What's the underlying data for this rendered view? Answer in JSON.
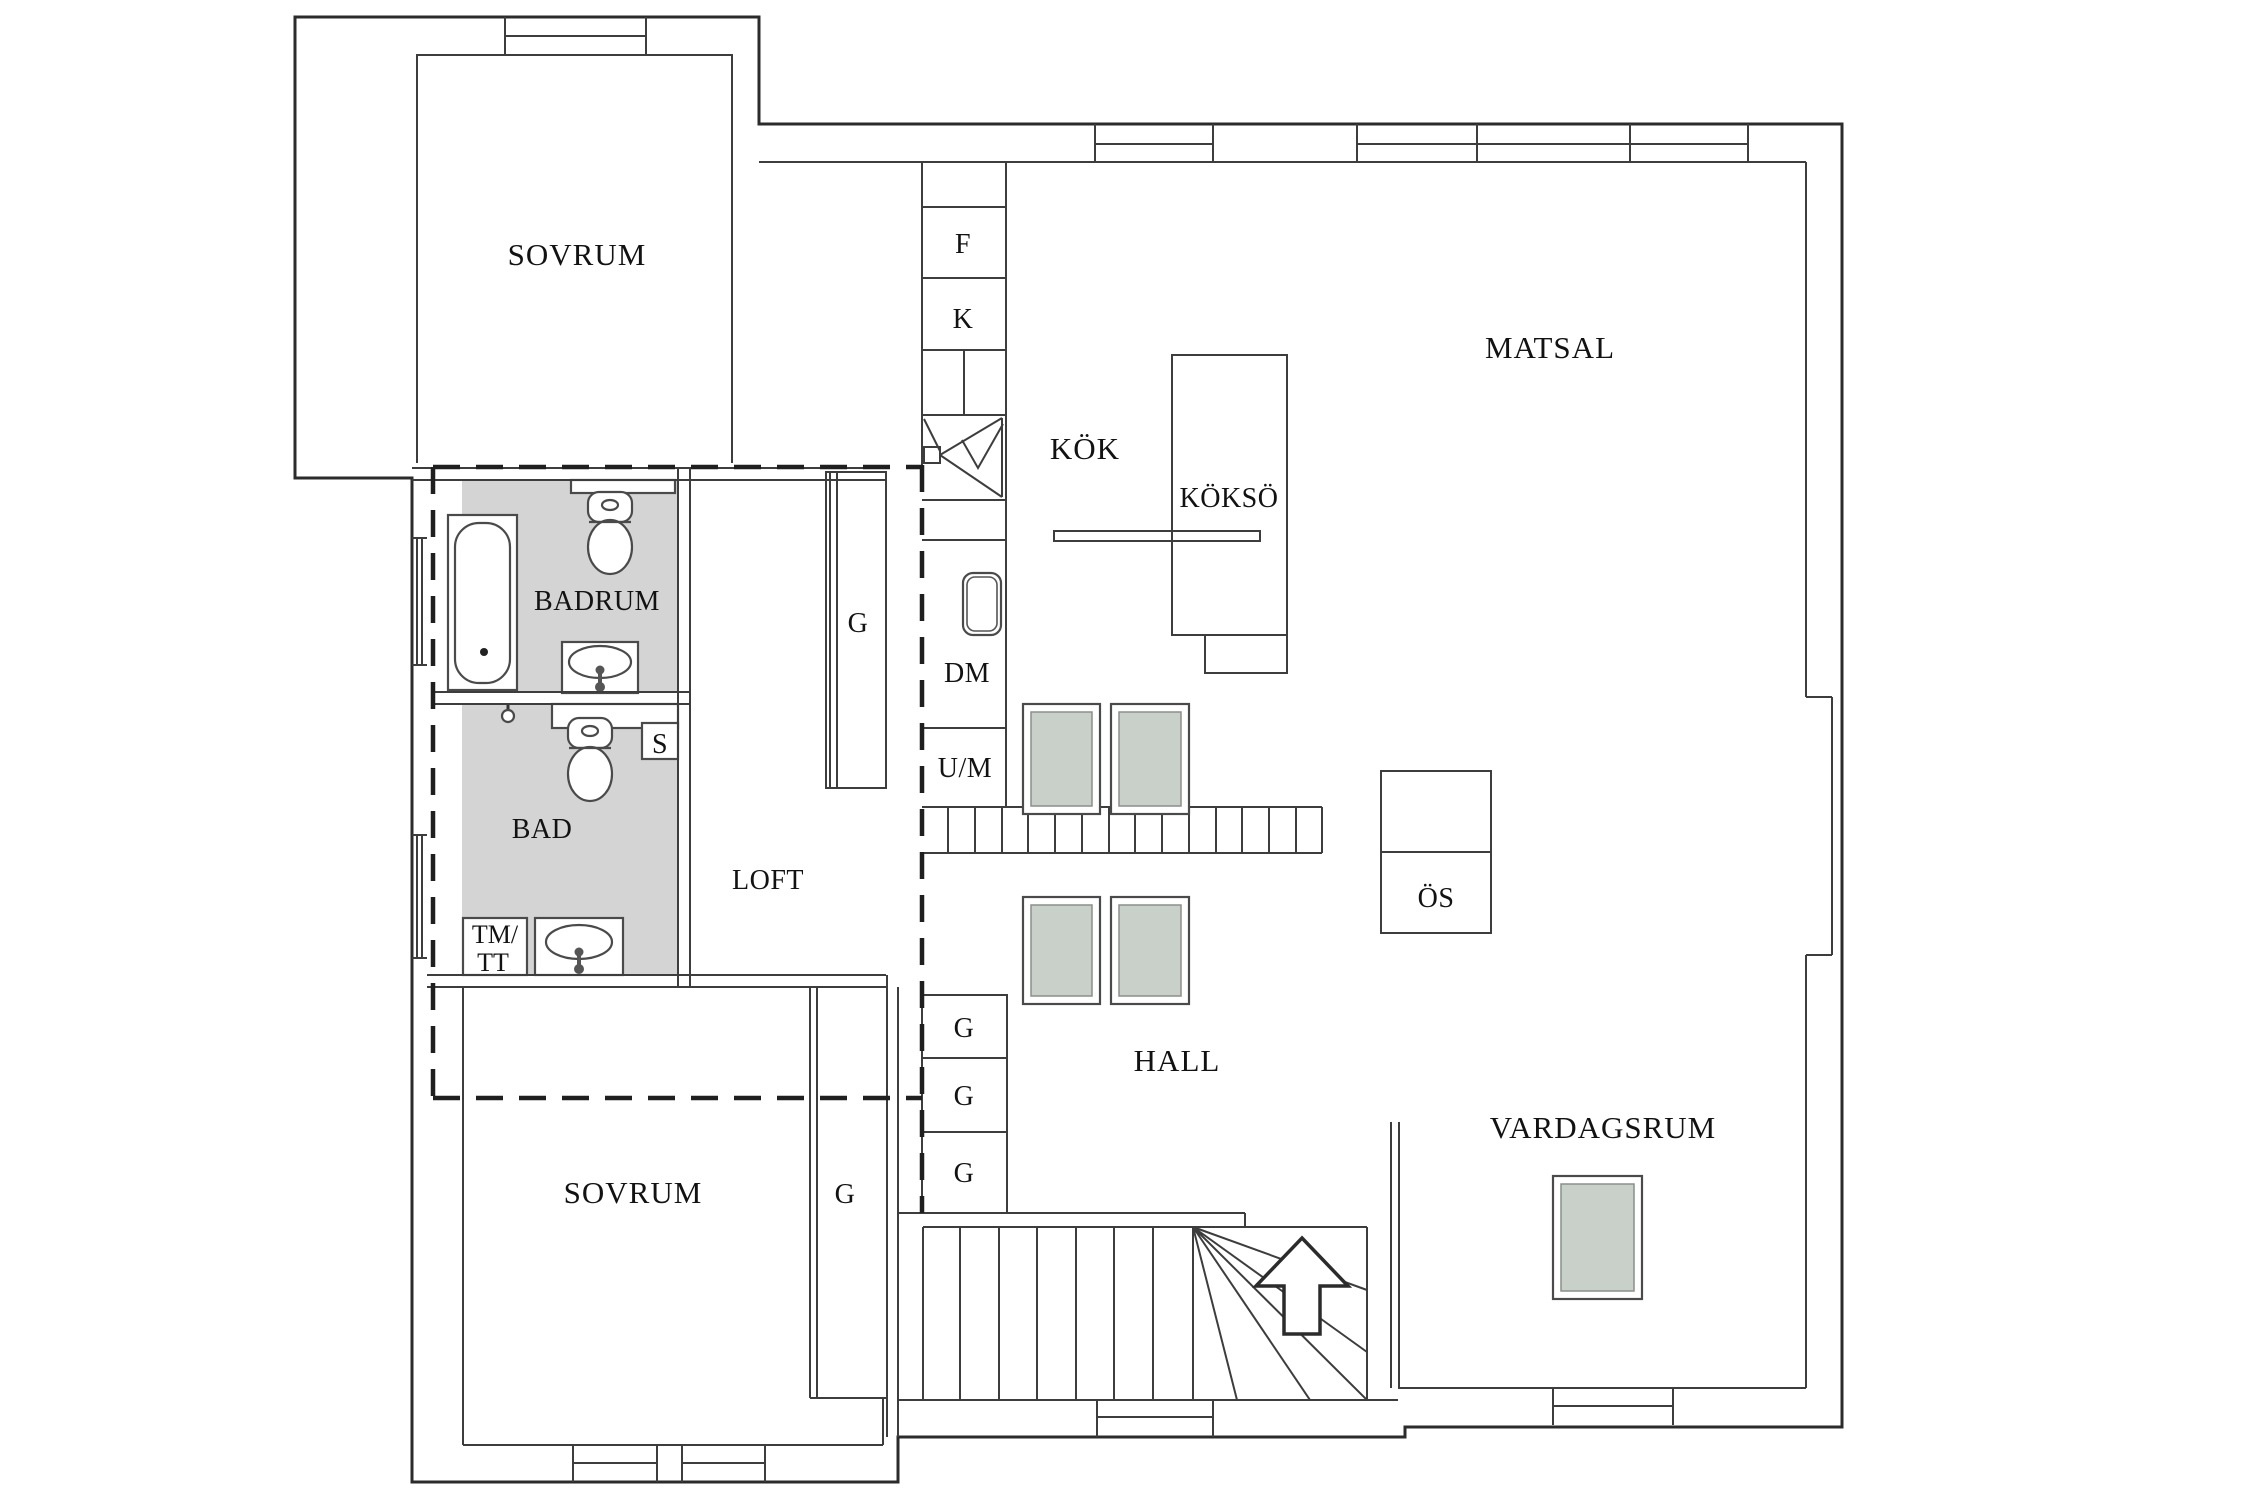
{
  "labels": {
    "sovrum_upper": "SOVRUM",
    "sovrum_lower": "SOVRUM",
    "badrum": "BADRUM",
    "bad": "BAD",
    "loft": "LOFT",
    "kok": "KÖK",
    "kokso": "KÖKSÖ",
    "matsal": "MATSAL",
    "hall": "HALL",
    "vardagsrum": "VARDAGSRUM",
    "fridge": "F",
    "freezer": "K",
    "dishwasher": "DM",
    "um": "U/M",
    "closet_s": "S",
    "wardrobe_g": "G",
    "tm_line1": "TM/",
    "tm_line2": "TT",
    "fireplace": "ÖS"
  },
  "colors": {
    "background": "#ffffff",
    "wet_floor": "#d4d4d4",
    "skylight": "#c9d0c9",
    "rug": "#c9d0c9",
    "outer_wall": "#2b2b2b",
    "inner_wall": "#3d3d3d",
    "dashed_line": "#1f1f1f",
    "text": "#121212"
  }
}
